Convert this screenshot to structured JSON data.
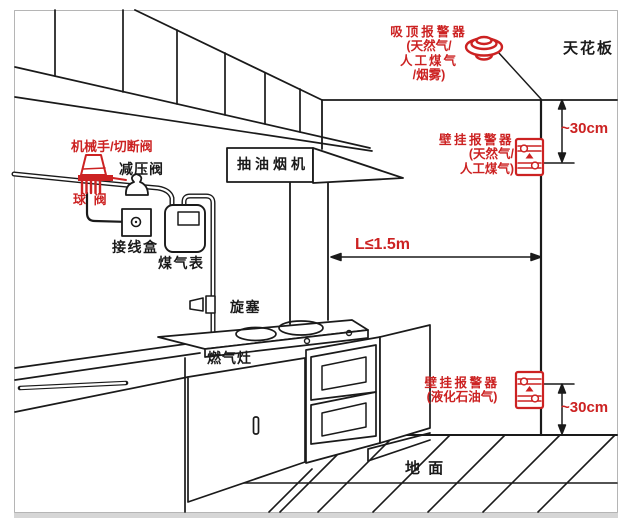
{
  "colors": {
    "accent_red": "#cc2222",
    "line": "#1a1a1a"
  },
  "labels": {
    "ceiling": "天花板",
    "ground": "地 面",
    "range_hood": "抽油烟机",
    "gas_stove": "燃气灶",
    "mechanical_cutoff_valve": "机械手/切断阀",
    "reducing_valve": "减压阀",
    "ball_valve": "球 阀",
    "junction_box": "接线盒",
    "gas_meter": "煤气表",
    "plug_valve": "旋塞"
  },
  "alarms": {
    "ceiling_alarm": {
      "line1": "吸顶报警器",
      "line2": "(天然气/",
      "line3": "人工煤气",
      "line4": "/烟雾)"
    },
    "wall_alarm_upper": {
      "line1": "壁挂报警器",
      "line2": "(天然气/",
      "line3": "人工煤气)"
    },
    "wall_alarm_lower": {
      "line1": "壁挂报警器",
      "line2": "(液化石油气)"
    }
  },
  "dimensions": {
    "ceiling_offset": "~30cm",
    "floor_offset": "~30cm",
    "distance_to_wall": "L≤1.5m"
  }
}
